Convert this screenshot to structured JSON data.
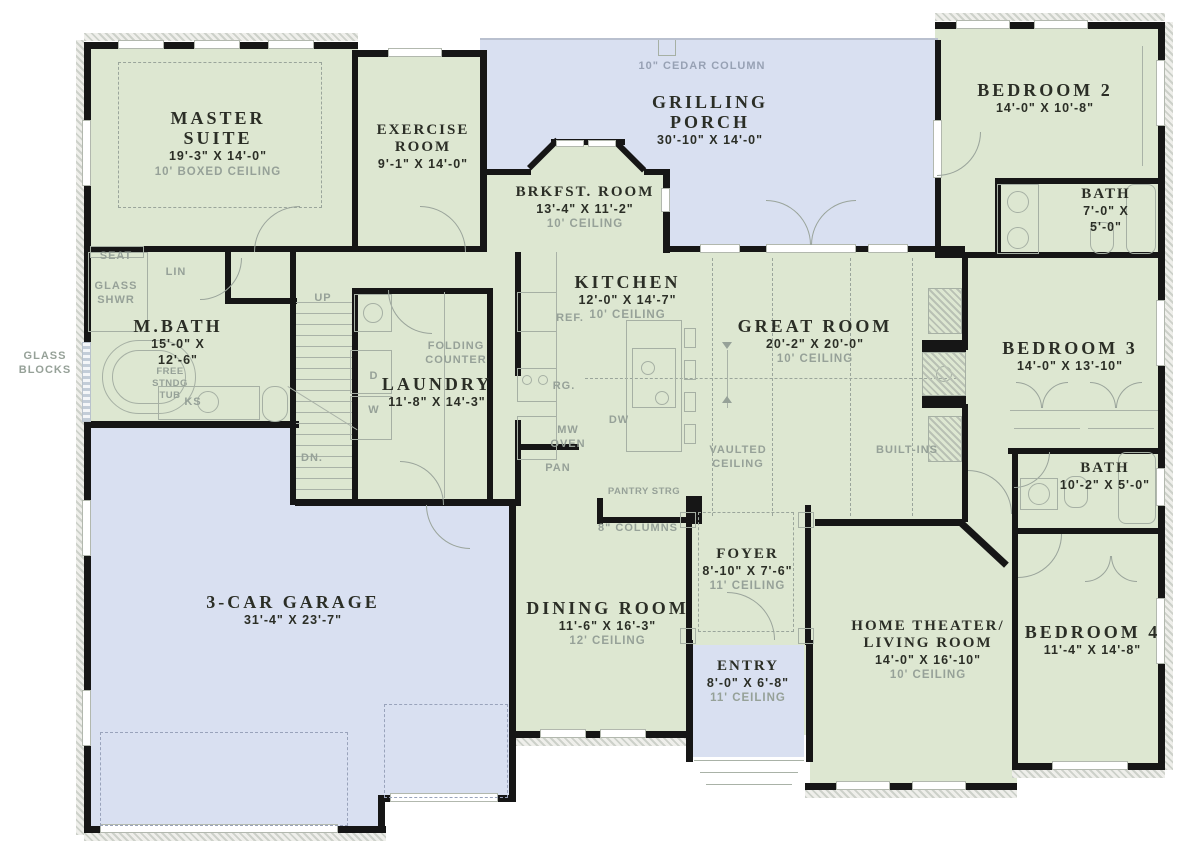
{
  "palette": {
    "room_fill_green": "#dde7d1",
    "porch_garage_fill_blue": "#d9e0f1",
    "wall_black": "#161616",
    "label_ink": "#2b2e26",
    "muted_green_text": "#96a198",
    "muted_blue_text": "#97a1b4"
  },
  "rooms": {
    "master_suite": {
      "name": "MASTER\nSUITE",
      "dims": "19'-3\" X 14'-0\"",
      "ceiling": "10' BOXED CEILING"
    },
    "exercise_room": {
      "name": "EXERCISE\nROOM",
      "dims": "9'-1\" X 14'-0\""
    },
    "grilling_porch": {
      "name": "GRILLING\nPORCH",
      "dims": "30'-10\" X 14'-0\""
    },
    "brkfst_room": {
      "name": "BRKFST. ROOM",
      "dims": "13'-4\" X 11'-2\"",
      "ceiling": "10' CEILING"
    },
    "bedroom_2": {
      "name": "BEDROOM 2",
      "dims": "14'-0\" X 10'-8\""
    },
    "bath_2": {
      "name": "BATH",
      "dims": "7'-0\" X\n5'-0\""
    },
    "kitchen": {
      "name": "KITCHEN",
      "dims": "12'-0\" X 14'-7\"",
      "ceiling": "10' CEILING"
    },
    "great_room": {
      "name": "GREAT ROOM",
      "dims": "20'-2\" X 20'-0\"",
      "ceiling": "10' CEILING"
    },
    "m_bath": {
      "name": "M.BATH",
      "dims": "15'-0\" X\n12'-6\""
    },
    "laundry": {
      "name": "LAUNDRY",
      "dims": "11'-8\" X 14'-3\""
    },
    "bedroom_3": {
      "name": "BEDROOM 3",
      "dims": "14'-0\" X 13'-10\""
    },
    "bath_3": {
      "name": "BATH",
      "dims": "10'-2\" X 5'-0\""
    },
    "garage": {
      "name": "3-CAR GARAGE",
      "dims": "31'-4\" X 23'-7\""
    },
    "dining_room": {
      "name": "DINING ROOM",
      "dims": "11'-6\" X 16'-3\"",
      "ceiling": "12' CEILING"
    },
    "foyer": {
      "name": "FOYER",
      "dims": "8'-10\" X 7'-6\"",
      "ceiling": "11' CEILING"
    },
    "entry": {
      "name": "ENTRY",
      "dims": "8'-0\" X 6'-8\"",
      "ceiling": "11' CEILING"
    },
    "home_theater": {
      "name": "HOME THEATER/\nLIVING ROOM",
      "dims": "14'-0\" X 16'-10\"",
      "ceiling": "10' CEILING"
    },
    "bedroom_4": {
      "name": "BEDROOM 4",
      "dims": "11'-4\" X 14'-8\""
    }
  },
  "notes": {
    "cedar_column": "10\" CEDAR COLUMN",
    "seat": "SEAT",
    "glass_shwr": "GLASS\nSHWR",
    "lin": "LIN",
    "glass_blocks": "GLASS\nBLOCKS",
    "free_stndg_tub": "FREE\nSTNDG\nTUB",
    "ks": "KS",
    "up": "UP",
    "dn": "DN.",
    "ref": "REF.",
    "rg": "RG.",
    "mw_oven": "MW\nOVEN",
    "dw": "DW",
    "pan": "PAN",
    "pantry_strg": "PANTRY STRG",
    "columns_8": "8\" COLUMNS",
    "vaulted_ceiling": "VAULTED\nCEILING",
    "built_ins": "BUILT-INS",
    "folding_counter": "FOLDING\nCOUNTER",
    "dryer": "D",
    "washer": "W"
  }
}
